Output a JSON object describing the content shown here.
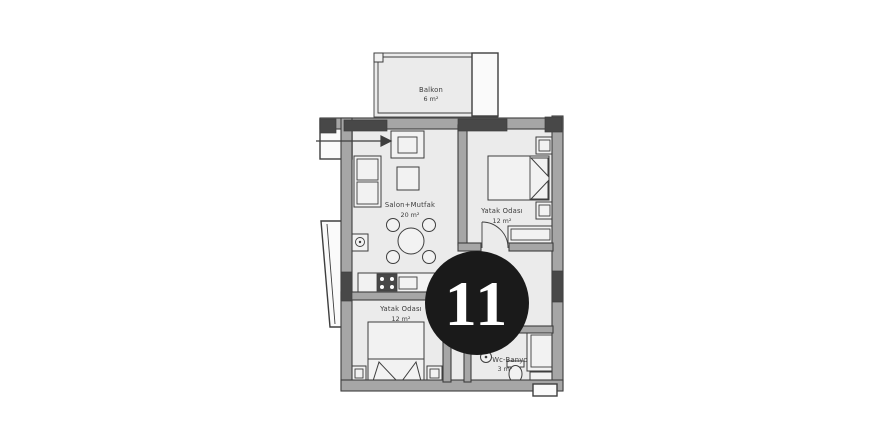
{
  "badge": {
    "number": "11"
  },
  "rooms": {
    "balcony": {
      "name": "Balkon",
      "area": "6 m²"
    },
    "living_kitchen": {
      "name": "Salon+Mutfak",
      "area": "20 m²"
    },
    "bedroom_right": {
      "name": "Yatak Odası",
      "area": "12 m²"
    },
    "bedroom_lower": {
      "name": "Yatak Odası",
      "area": "12 m²"
    },
    "bathroom": {
      "name": "Wc-Banyo",
      "area": "3 m²"
    }
  },
  "colors": {
    "background": "#ffffff",
    "floor": "#ebebeb",
    "wall": "#a6a6a6",
    "outline": "#3e3e3e",
    "window_block": "#484848",
    "furniture": "#f2f2f2",
    "exterior": "#fafafa",
    "badge_bg": "#1a1a1a",
    "badge_text": "#ffffff",
    "label": "#3c3c3c"
  }
}
